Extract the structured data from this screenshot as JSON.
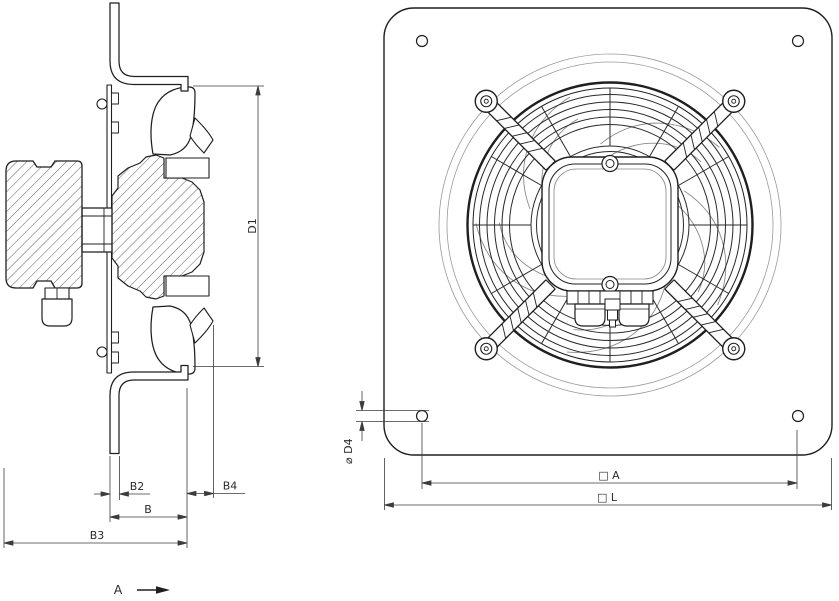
{
  "drawing": {
    "colors": {
      "line": "#1f1f1f",
      "dim": "#3c3c3c",
      "light": "#9a9a9a",
      "background": "#ffffff"
    },
    "side_view": {
      "dim_d1": "D1",
      "dim_b2": "B2",
      "dim_b4": "B4",
      "dim_b": "B",
      "dim_b3": "B3",
      "view_label": "A"
    },
    "front_view": {
      "dim_d4": "⌀ D4",
      "dim_a": "□ A",
      "dim_l": "□ L"
    }
  }
}
